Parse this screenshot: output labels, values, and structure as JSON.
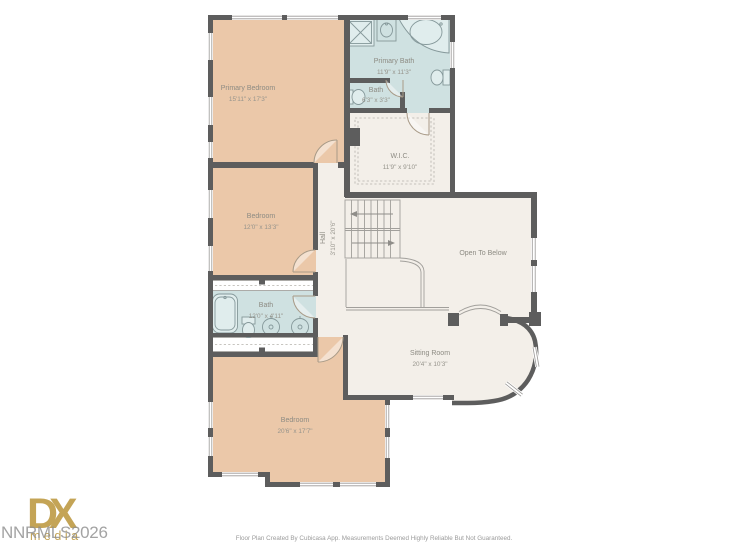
{
  "rooms": {
    "primary_bedroom": {
      "name": "Primary Bedroom",
      "dims": "15'11\" x 17'3\""
    },
    "primary_bath": {
      "name": "Primary Bath",
      "dims": "11'9\" x 11'3\""
    },
    "bath_upper": {
      "name": "Bath",
      "dims": "6'3\" x 3'3\""
    },
    "wic": {
      "name": "W.I.C.",
      "dims": "11'9\" x 9'10\""
    },
    "bedroom_middle": {
      "name": "Bedroom",
      "dims": "12'0\" x 13'3\""
    },
    "hall": {
      "name": "Hall",
      "dims": "3'10\" x 20'6\""
    },
    "open_to_below": {
      "name": "Open To Below"
    },
    "bath_middle": {
      "name": "Bath",
      "dims": "12'0\" x 4'11\""
    },
    "sitting_room": {
      "name": "Sitting Room",
      "dims": "20'4\" x 10'3\""
    },
    "bedroom_lower": {
      "name": "Bedroom",
      "dims": "20'6\" x 17'7\""
    }
  },
  "footer": {
    "disclaimer": "Floor Plan Created By Cubicasa App. Measurements Deemed Highly Reliable But Not Guaranteed."
  },
  "watermark": {
    "text": "NNRMLS2026"
  },
  "logo": {
    "dx": "DX",
    "media": "media"
  },
  "colors": {
    "wall": "#5d5d5d",
    "bedroom_fill": "#ebc8a9",
    "bath_fill": "#cfe1e1",
    "floor_fill": "#f3efe9",
    "label_text": "#8d8b83",
    "logo_gold": "#c1a04d",
    "watermark_gray": "#8f8f8f"
  }
}
